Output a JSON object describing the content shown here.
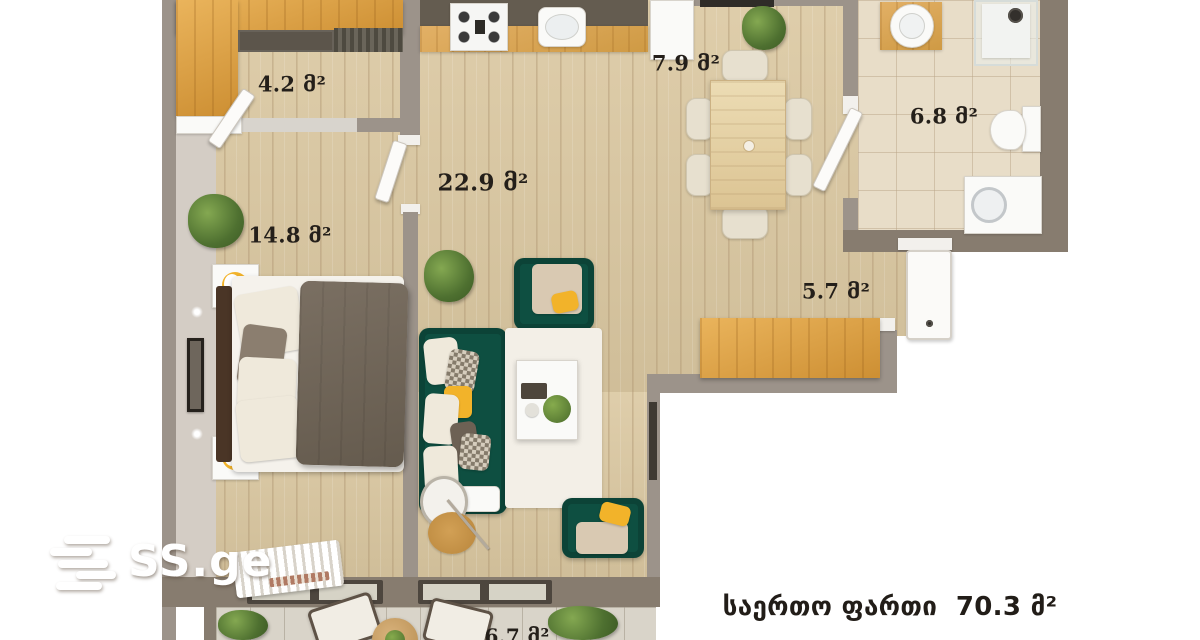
{
  "branding": {
    "logo_text": "SS.ge"
  },
  "summary": {
    "total_area_text": "საერთო ფართი  70.3 მ²"
  },
  "rooms": [
    {
      "name": "storage",
      "area_label": "4.2 მ²"
    },
    {
      "name": "dining",
      "area_label": "7.9 მ²"
    },
    {
      "name": "living-kitchen",
      "area_label": "22.9 მ²"
    },
    {
      "name": "bedroom",
      "area_label": "14.8 მ²"
    },
    {
      "name": "bathroom",
      "area_label": "6.8 მ²"
    },
    {
      "name": "balcony-east",
      "area_label": "5.7 მ²"
    },
    {
      "name": "balcony-south",
      "area_label": "6.7 მ²"
    }
  ],
  "colors": {
    "wall": "#9c938a",
    "wall_dark": "#877c6f",
    "floor_wood": "#dbc8a1",
    "cabinet_wood": "#dfa449",
    "tile": "#e8ddc8",
    "sofa_green": "#0e4f41",
    "accent_yellow": "#f2b32a",
    "duvet_taupe": "#6d6154",
    "headboard_brown": "#4a3526",
    "label_text": "#241f1a",
    "logo_white": "#ffffff"
  }
}
